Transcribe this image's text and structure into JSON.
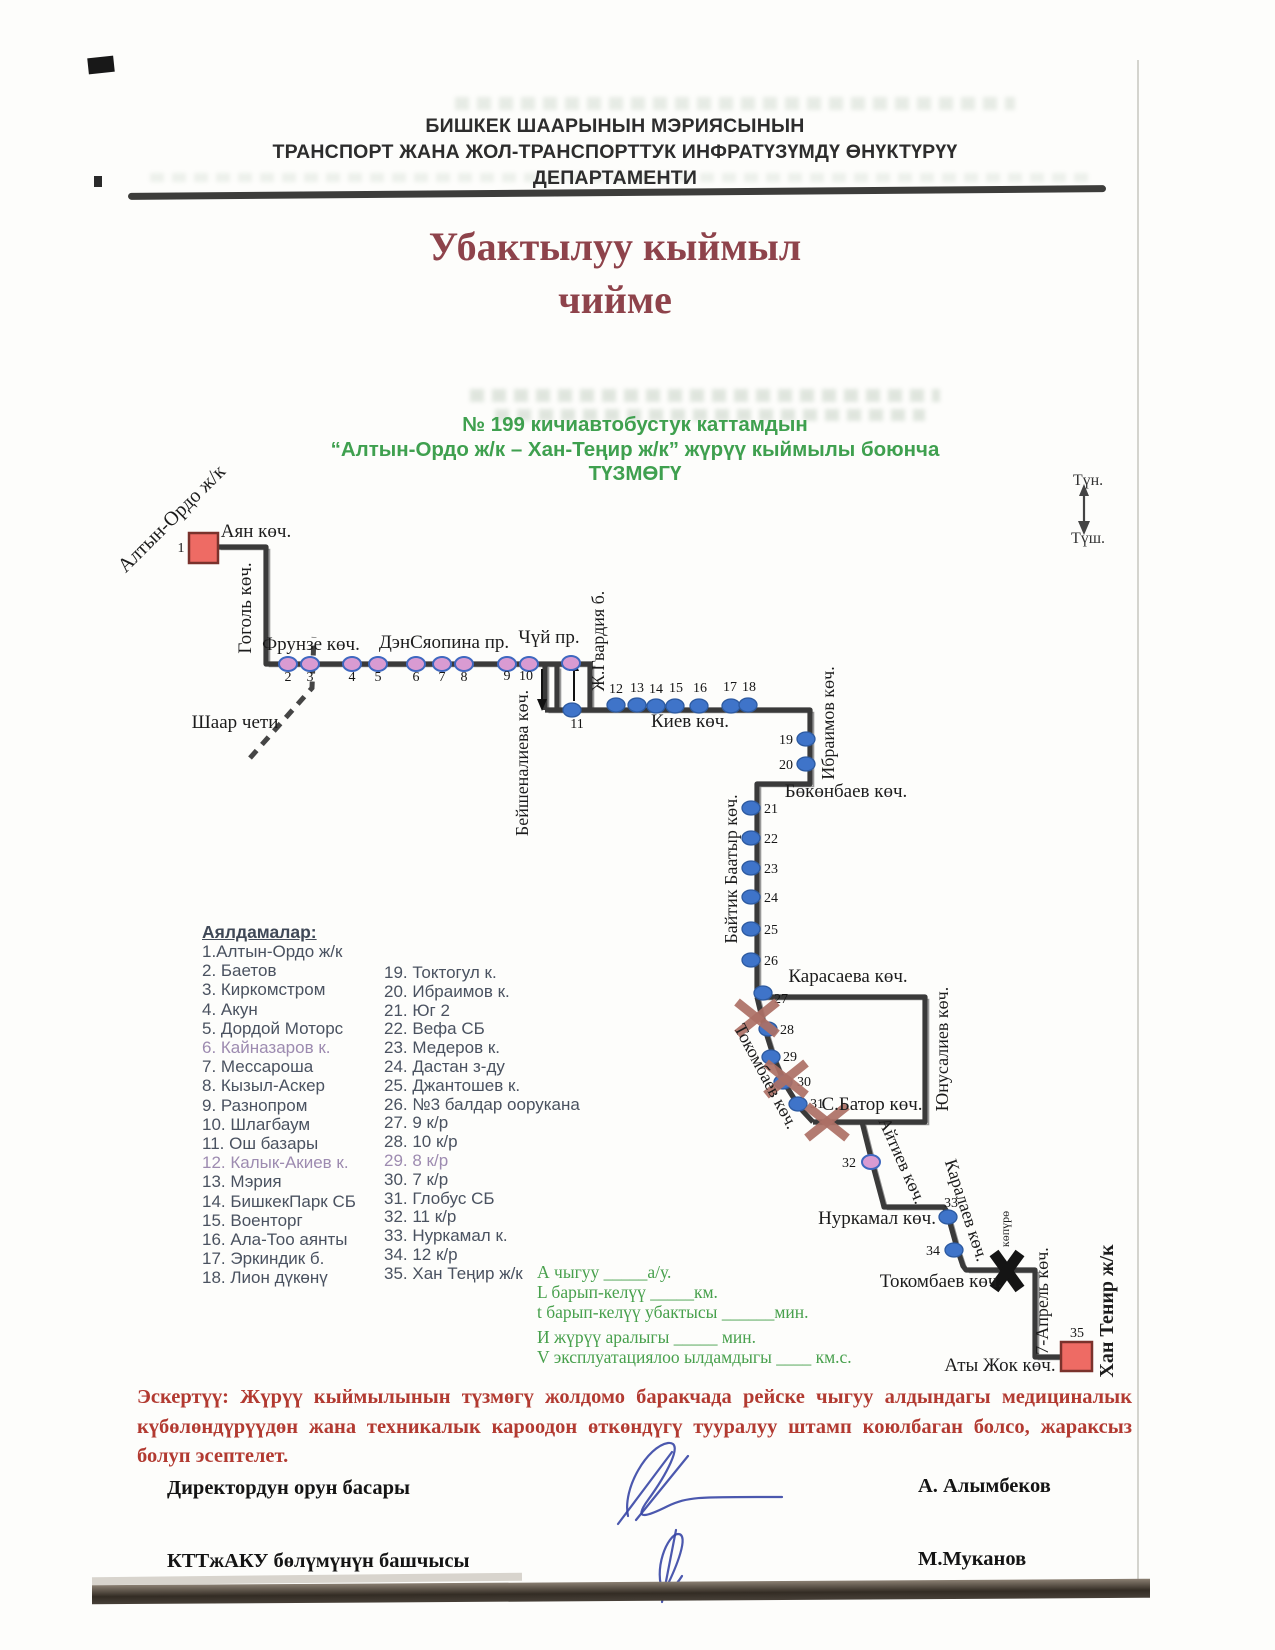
{
  "header": {
    "lines": [
      "БИШКЕК ШААРЫНЫН  МЭРИЯСЫНЫН",
      "ТРАНСПОРТ ЖАНА ЖОЛ-ТРАНСПОРТТУК ИНФРАТҮЗҮМДҮ ӨНҮКТҮРҮҮ",
      "ДЕПАРТАМЕНТИ"
    ]
  },
  "title": {
    "lines": [
      "Убактылуу кыймыл",
      "чийме"
    ]
  },
  "subtitle": {
    "lines": [
      "№ 199 кичиавтобустук каттамдын",
      "“Алтын-Ордо ж/к – Хан-Теңир ж/к” жүрүү кыймылы боюнча",
      "ТҮЗМӨГҮ"
    ]
  },
  "stops": {
    "heading": "Аялдамалар:",
    "col1": [
      {
        "t": "1.Алтын-Ордо ж/к",
        "m": false
      },
      {
        "t": "2. Баетов",
        "m": false
      },
      {
        "t": "3. Киркомстром",
        "m": false
      },
      {
        "t": "4. Акун",
        "m": false
      },
      {
        "t": "5. Дордой Моторс",
        "m": false
      },
      {
        "t": "6. Кайназаров к.",
        "m": true
      },
      {
        "t": "7. Мессароша",
        "m": false
      },
      {
        "t": "8. Кызыл-Аскер",
        "m": false
      },
      {
        "t": "9. Разнопром",
        "m": false
      },
      {
        "t": "10. Шлагбаум",
        "m": false
      },
      {
        "t": "11. Ош базары",
        "m": false
      },
      {
        "t": "12. Калык-Акиев к.",
        "m": true
      },
      {
        "t": "13. Мэрия",
        "m": false
      },
      {
        "t": "14. БишкекПарк СБ",
        "m": false
      },
      {
        "t": "15. Военторг",
        "m": false
      },
      {
        "t": "16. Ала-Тоо аянты",
        "m": false
      },
      {
        "t": "17. Эркиндик б.",
        "m": false
      },
      {
        "t": "18. Лион дүкөнү",
        "m": false
      }
    ],
    "col2": [
      {
        "t": "19. Токтогул к.",
        "m": false
      },
      {
        "t": "20. Ибраимов к.",
        "m": false
      },
      {
        "t": "21. Юг 2",
        "m": false
      },
      {
        "t": "22. Вефа СБ",
        "m": false
      },
      {
        "t": "23. Медеров к.",
        "m": false
      },
      {
        "t": "24. Дастан з-ду",
        "m": false
      },
      {
        "t": "25. Джантошев к.",
        "m": false
      },
      {
        "t": "26. №3 балдар оорукана",
        "m": false
      },
      {
        "t": "27. 9 к/р",
        "m": false
      },
      {
        "t": "28. 10 к/р",
        "m": false
      },
      {
        "t": "29. 8 к/р",
        "m": true
      },
      {
        "t": "30. 7 к/р",
        "m": false
      },
      {
        "t": "31. Глобус СБ",
        "m": false
      },
      {
        "t": "32. 11 к/р",
        "m": false
      },
      {
        "t": "33. Нуркамал к.",
        "m": false
      },
      {
        "t": "34. 12 к/р",
        "m": false
      },
      {
        "t": "35. Хан Теңир ж/к",
        "m": false
      }
    ]
  },
  "legend": {
    "lines": [
      "А чыгуу  _____а/у.",
      "L барып-келүү  _____км.",
      "t барып-келүү убактысы ______мин.",
      "И жүрүү аралыгы _____  мин.",
      "V эксплуатациялоо ылдамдыгы ____ км.с."
    ]
  },
  "note": {
    "label": "Эскертүү:",
    "text": "Жүрүү кыймылынын түзмөгү жолдомо баракчада рейске чыгуу алдындагы медициналык күбөлөндүрүүдөн жана техникалык кароодон өткөндүгү тууралуу штамп коюлбаган болсо, жараксыз болуп эсептелет."
  },
  "signatures": [
    {
      "role": "Директордун орун басары",
      "name": "А. Алымбеков",
      "top": 1477
    },
    {
      "role": "КТТжАКУ  бөлүмүнүн башчысы",
      "name": "М.Муканов",
      "top": 1550
    }
  ],
  "diagram": {
    "colors": {
      "route": "#3a3a3a",
      "echo": "#979797",
      "pink_fill": "#d99bd2",
      "pink_stroke": "#3f68c0",
      "blue_fill": "#3f74c9",
      "blue_stroke": "#2d5aa0",
      "square_fill": "#ee6b64",
      "square_stroke": "#7a322c",
      "xmark": "#ad7066",
      "label": "#1c1c1c",
      "ink": "#3746a5"
    },
    "segments": [
      [
        [
          217,
          547
        ],
        [
          266,
          547
        ],
        [
          266,
          664
        ],
        [
          592,
          664
        ]
      ],
      [
        [
          545,
          664
        ],
        [
          545,
          710
        ]
      ],
      [
        [
          557,
          666
        ],
        [
          557,
          708
        ]
      ],
      [
        [
          590,
          666
        ],
        [
          590,
          708
        ]
      ],
      [
        [
          545,
          710
        ],
        [
          810,
          710
        ],
        [
          810,
          784
        ],
        [
          757,
          784
        ],
        [
          757,
          997
        ]
      ],
      [
        [
          757,
          997
        ],
        [
          925,
          997
        ],
        [
          925,
          1122
        ],
        [
          813,
          1122
        ]
      ],
      [
        [
          757,
          997
        ],
        [
          764,
          1026
        ],
        [
          774,
          1058
        ],
        [
          785,
          1084
        ],
        [
          800,
          1108
        ],
        [
          813,
          1122
        ]
      ],
      [
        [
          862,
          1122
        ],
        [
          872,
          1162
        ],
        [
          883,
          1203
        ],
        [
          884,
          1207
        ],
        [
          944,
          1207
        ],
        [
          947,
          1212
        ],
        [
          957,
          1248
        ],
        [
          963,
          1266
        ],
        [
          966,
          1270
        ],
        [
          1035,
          1270
        ],
        [
          1035,
          1357
        ],
        [
          1063,
          1357
        ]
      ]
    ],
    "terminals": [
      {
        "x": 189,
        "y": 533,
        "w": 29,
        "h": 30,
        "num": "1",
        "nx": 181,
        "ny": 552
      },
      {
        "x": 1061,
        "y": 1342,
        "w": 31,
        "h": 29,
        "num": "35",
        "nx": 1077,
        "ny": 1337
      }
    ],
    "stops": [
      {
        "n": "2",
        "x": 288,
        "y": 664,
        "c": "pink",
        "lx": 288,
        "ly": 681,
        "a": "middle"
      },
      {
        "n": "3",
        "x": 310,
        "y": 664,
        "c": "pink",
        "lx": 310,
        "ly": 681,
        "a": "middle"
      },
      {
        "n": "4",
        "x": 352,
        "y": 664,
        "c": "pink",
        "lx": 352,
        "ly": 681,
        "a": "middle"
      },
      {
        "n": "5",
        "x": 378,
        "y": 664,
        "c": "pink",
        "lx": 378,
        "ly": 681,
        "a": "middle"
      },
      {
        "n": "6",
        "x": 416,
        "y": 664,
        "c": "pink",
        "lx": 416,
        "ly": 681,
        "a": "middle"
      },
      {
        "n": "7",
        "x": 442,
        "y": 664,
        "c": "pink",
        "lx": 442,
        "ly": 681,
        "a": "middle"
      },
      {
        "n": "8",
        "x": 464,
        "y": 664,
        "c": "pink",
        "lx": 464,
        "ly": 681,
        "a": "middle"
      },
      {
        "n": "9",
        "x": 507,
        "y": 664,
        "c": "pink",
        "lx": 507,
        "ly": 680,
        "a": "middle"
      },
      {
        "n": "10",
        "x": 529,
        "y": 664,
        "c": "pink",
        "lx": 526,
        "ly": 680,
        "a": "middle"
      },
      {
        "n": "",
        "x": 571,
        "y": 663,
        "c": "pink",
        "lx": 0,
        "ly": 0,
        "a": "middle"
      },
      {
        "n": "11",
        "x": 572,
        "y": 710,
        "c": "blue",
        "lx": 577,
        "ly": 728,
        "a": "middle"
      },
      {
        "n": "12",
        "x": 616,
        "y": 705,
        "c": "blue",
        "lx": 616,
        "ly": 693,
        "a": "middle"
      },
      {
        "n": "13",
        "x": 637,
        "y": 705,
        "c": "blue",
        "lx": 637,
        "ly": 692,
        "a": "middle"
      },
      {
        "n": "14",
        "x": 656,
        "y": 706,
        "c": "blue",
        "lx": 656,
        "ly": 693,
        "a": "middle"
      },
      {
        "n": "15",
        "x": 675,
        "y": 706,
        "c": "blue",
        "lx": 676,
        "ly": 692,
        "a": "middle"
      },
      {
        "n": "16",
        "x": 699,
        "y": 706,
        "c": "blue",
        "lx": 700,
        "ly": 692,
        "a": "middle"
      },
      {
        "n": "17",
        "x": 731,
        "y": 706,
        "c": "blue",
        "lx": 730,
        "ly": 691,
        "a": "middle"
      },
      {
        "n": "18",
        "x": 748,
        "y": 705,
        "c": "blue",
        "lx": 749,
        "ly": 691,
        "a": "middle"
      },
      {
        "n": "19",
        "x": 806,
        "y": 739,
        "c": "blue",
        "lx": 793,
        "ly": 744,
        "a": "end"
      },
      {
        "n": "20",
        "x": 806,
        "y": 764,
        "c": "blue",
        "lx": 793,
        "ly": 769,
        "a": "end"
      },
      {
        "n": "21",
        "x": 751,
        "y": 808,
        "c": "blue",
        "lx": 764,
        "ly": 813,
        "a": "start"
      },
      {
        "n": "22",
        "x": 751,
        "y": 838,
        "c": "blue",
        "lx": 764,
        "ly": 843,
        "a": "start"
      },
      {
        "n": "23",
        "x": 751,
        "y": 868,
        "c": "blue",
        "lx": 764,
        "ly": 873,
        "a": "start"
      },
      {
        "n": "24",
        "x": 751,
        "y": 897,
        "c": "blue",
        "lx": 764,
        "ly": 902,
        "a": "start"
      },
      {
        "n": "25",
        "x": 751,
        "y": 929,
        "c": "blue",
        "lx": 764,
        "ly": 934,
        "a": "start"
      },
      {
        "n": "26",
        "x": 751,
        "y": 960,
        "c": "blue",
        "lx": 764,
        "ly": 965,
        "a": "start"
      },
      {
        "n": "27",
        "x": 763,
        "y": 993,
        "c": "blue",
        "lx": 774,
        "ly": 1003,
        "a": "start"
      },
      {
        "n": "28",
        "x": 768,
        "y": 1029,
        "c": "blue",
        "lx": 780,
        "ly": 1034,
        "a": "start"
      },
      {
        "n": "29",
        "x": 771,
        "y": 1057,
        "c": "blue",
        "lx": 783,
        "ly": 1061,
        "a": "start"
      },
      {
        "n": "30",
        "x": 783,
        "y": 1082,
        "c": "blue",
        "lx": 797,
        "ly": 1086,
        "a": "start"
      },
      {
        "n": "31",
        "x": 798,
        "y": 1104,
        "c": "blue",
        "lx": 810,
        "ly": 1108,
        "a": "start"
      },
      {
        "n": "32",
        "x": 871,
        "y": 1162,
        "c": "pink",
        "lx": 856,
        "ly": 1167,
        "a": "end"
      },
      {
        "n": "33",
        "x": 948,
        "y": 1217,
        "c": "blue",
        "lx": 944,
        "ly": 1207,
        "a": "start"
      },
      {
        "n": "34",
        "x": 954,
        "y": 1250,
        "c": "blue",
        "lx": 940,
        "ly": 1255,
        "a": "end"
      }
    ],
    "x_marks": [
      [
        757,
        1018
      ],
      [
        786,
        1079
      ],
      [
        827,
        1122
      ]
    ],
    "arrows": [
      {
        "x": 542,
        "y1": 669,
        "y2": 700,
        "dir": "down"
      },
      {
        "x": 574,
        "y1": 701,
        "y2": 670,
        "dir": "up"
      }
    ],
    "bridge": {
      "x": 1007,
      "y": 1271
    },
    "boundary_dash": [
      [
        250,
        758
      ],
      [
        312,
        688
      ],
      [
        314,
        637
      ]
    ],
    "labels": [
      {
        "t": "Аян көч.",
        "x": 256,
        "y": 537,
        "r": 0,
        "s": 19,
        "b": false
      },
      {
        "t": "Гоголь көч.",
        "x": 251,
        "y": 608,
        "r": -90,
        "s": 19,
        "b": false
      },
      {
        "t": "Фрунзе көч.",
        "x": 311,
        "y": 650,
        "r": 0,
        "s": 19,
        "b": false
      },
      {
        "t": "ДэнСяопина пр.",
        "x": 444,
        "y": 648,
        "r": 0,
        "s": 19,
        "b": false
      },
      {
        "t": "Чүй пр.",
        "x": 549,
        "y": 643,
        "r": 0,
        "s": 19,
        "b": false
      },
      {
        "t": "Шаар чети",
        "x": 235,
        "y": 728,
        "r": 0,
        "s": 19,
        "b": false
      },
      {
        "t": "Бейшеналиева көч.",
        "x": 528,
        "y": 763,
        "r": -90,
        "s": 18,
        "b": false
      },
      {
        "t": "Ж.Гвардия б.",
        "x": 604,
        "y": 641,
        "r": -90,
        "s": 18,
        "b": false
      },
      {
        "t": "Киев көч.",
        "x": 690,
        "y": 727,
        "r": 0,
        "s": 19,
        "b": false
      },
      {
        "t": "Ибраимов көч.",
        "x": 834,
        "y": 723,
        "r": -90,
        "s": 18,
        "b": false
      },
      {
        "t": "Бөкөнбаев көч.",
        "x": 846,
        "y": 797,
        "r": 0,
        "s": 19,
        "b": false
      },
      {
        "t": "Байтик Баатыр көч.",
        "x": 737,
        "y": 869,
        "r": -90,
        "s": 18,
        "b": false
      },
      {
        "t": "Карасаева көч.",
        "x": 848,
        "y": 982,
        "r": 0,
        "s": 19,
        "b": false
      },
      {
        "t": "Юнусалиев көч.",
        "x": 948,
        "y": 1049,
        "r": -90,
        "s": 18,
        "b": false
      },
      {
        "t": "Токомбаев көч.",
        "x": 761,
        "y": 1079,
        "r": 62,
        "s": 18,
        "b": false
      },
      {
        "t": "С.Батор көч.",
        "x": 872,
        "y": 1110,
        "r": 0,
        "s": 19,
        "b": false
      },
      {
        "t": "Айтиев көч.",
        "x": 897,
        "y": 1163,
        "r": 66,
        "s": 18,
        "b": false
      },
      {
        "t": "Нуркамал көч.",
        "x": 877,
        "y": 1224,
        "r": 0,
        "s": 19,
        "b": false
      },
      {
        "t": "Каралаев көч.",
        "x": 961,
        "y": 1212,
        "r": 72,
        "s": 18,
        "b": false
      },
      {
        "t": "көпүрө",
        "x": 1009,
        "y": 1229,
        "r": -90,
        "s": 12,
        "b": false
      },
      {
        "t": "Токомбаев  көч.",
        "x": 941,
        "y": 1287,
        "r": 0,
        "s": 19,
        "b": false
      },
      {
        "t": "7-Апрель көч.",
        "x": 1048,
        "y": 1301,
        "r": -90,
        "s": 18,
        "b": false
      },
      {
        "t": "Аты Жок көч.",
        "x": 1000,
        "y": 1371,
        "r": 0,
        "s": 19,
        "b": false
      },
      {
        "t": "Хан Тенир ж/к",
        "x": 1113,
        "y": 1311,
        "r": -90,
        "s": 20,
        "b": true
      },
      {
        "t": "Алтын-Ордо ж/к",
        "x": 176,
        "y": 523,
        "r": -45,
        "s": 20,
        "b": false
      }
    ],
    "compass": {
      "north": "Түн.",
      "south": "Түш.",
      "tx": 1088,
      "ny": 485,
      "sy": 543,
      "ax": 1084,
      "ay1": 492,
      "ay2": 525
    }
  }
}
